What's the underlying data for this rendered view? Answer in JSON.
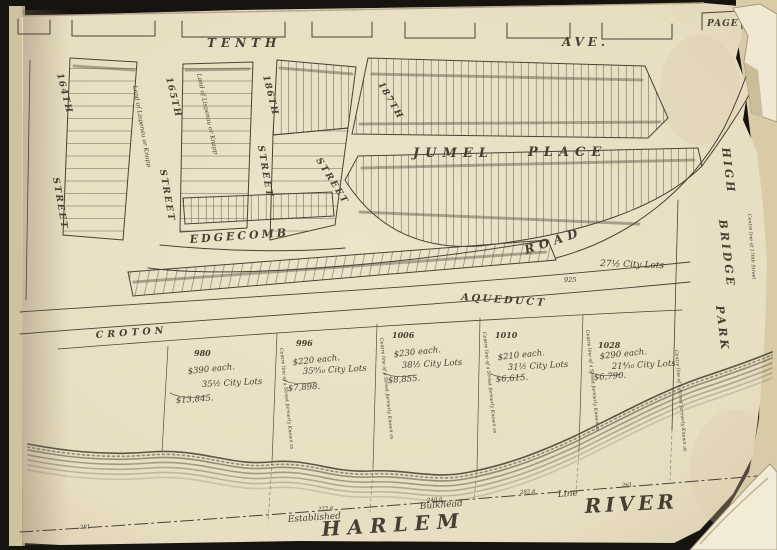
{
  "colors": {
    "backdrop": "#17130f",
    "paper": "#e9dfc4",
    "ink": "#463f33",
    "script": "#4d463c"
  },
  "page_corner_label": "PAGE",
  "avenue": {
    "tenth": "TENTH",
    "ave": "AVE."
  },
  "streets": {
    "s164_num": "164TH",
    "s164_word": "STREET",
    "s165_num": "165TH",
    "s165_word": "STREET",
    "s186_num": "186TH",
    "s186_word": "STREET",
    "s187_num": "187TH",
    "s187_word": "STREET"
  },
  "places": {
    "jumel": "JUMEL",
    "place": "PLACE",
    "edgecomb": "EDGECOMB",
    "road": "ROAD",
    "croton": "CROTON",
    "aqueduct": "AQUEDUCT",
    "high": "HIGH",
    "bridge": "BRIDGE",
    "park": "PARK",
    "harlem": "HARLEM",
    "river": "RIVER"
  },
  "bulkhead": {
    "established": "Established",
    "bulkhead": "Bulkhead",
    "line": "Line",
    "m0": "281",
    "m1": "272.6",
    "m2": "240.6",
    "m3": "282.6",
    "m4": "261"
  },
  "notes": {
    "land": "Land of Lispenau or Knapp",
    "city_lots": "27½ City Lots",
    "aqueduct_lot": "925",
    "centre_line": "Centre line of a Street formerly Known as",
    "centre_line_right": "Centre line of 170th Street"
  },
  "parcels": [
    {
      "id": "980",
      "price": "$390 each.",
      "lots": "35½ City Lots",
      "total": "$13,845."
    },
    {
      "id": "996",
      "price": "$220 each.",
      "lots": "35⁹⁄₁₀ City Lots",
      "total": "$7,898."
    },
    {
      "id": "1006",
      "price": "$230 each.",
      "lots": "38½ City Lots",
      "total": "$8,855."
    },
    {
      "id": "1010",
      "price": "$210 each.",
      "lots": "31½ City Lots",
      "total": "$6,615."
    },
    {
      "id": "1028",
      "price": "$290 each.",
      "lots": "21⁴⁄₁₀ City Lots",
      "total": "$6,790."
    }
  ]
}
